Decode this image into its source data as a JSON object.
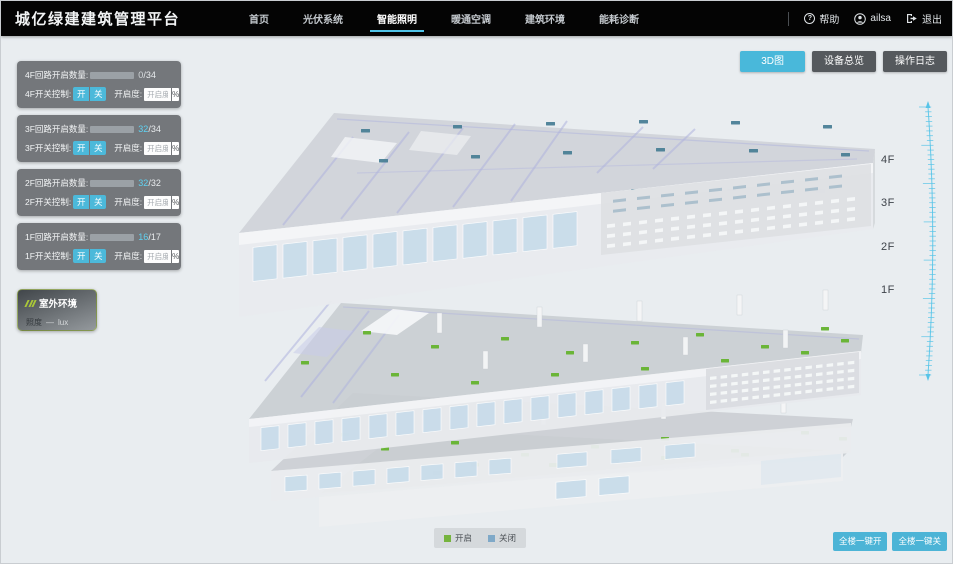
{
  "app": {
    "title": "城亿绿建建筑管理平台"
  },
  "nav": {
    "items": [
      {
        "label": "首页",
        "active": false
      },
      {
        "label": "光伏系统",
        "active": false
      },
      {
        "label": "智能照明",
        "active": true
      },
      {
        "label": "暖通空调",
        "active": false
      },
      {
        "label": "建筑环境",
        "active": false
      },
      {
        "label": "能耗诊断",
        "active": false
      }
    ]
  },
  "user_menu": {
    "help": "帮助",
    "username": "ailsa",
    "logout": "退出"
  },
  "view_toolbar": {
    "buttons": [
      {
        "label": "3D图",
        "active": true
      },
      {
        "label": "设备总览",
        "active": false
      },
      {
        "label": "操作日志",
        "active": false
      }
    ]
  },
  "floor_panels": [
    {
      "floor": "4F",
      "count_label": "4F回路开启数量:",
      "open": "0",
      "total_text": "/34",
      "open_style": "color:#d4d9dc",
      "bar_style": "width:0%",
      "switch_label": "4F开关控制:",
      "on_label": "开",
      "off_label": "关",
      "dim_label": "开启度:",
      "dim_placeholder": "开启度",
      "percent_label": "%"
    },
    {
      "floor": "3F",
      "count_label": "3F回路开启数量:",
      "open": "32",
      "total_text": "/34",
      "open_style": "color:#5fd2f2",
      "bar_style": "width:94%",
      "switch_label": "3F开关控制:",
      "on_label": "开",
      "off_label": "关",
      "dim_label": "开启度:",
      "dim_placeholder": "开启度",
      "percent_label": "%"
    },
    {
      "floor": "2F",
      "count_label": "2F回路开启数量:",
      "open": "32",
      "total_text": "/32",
      "open_style": "color:#5fd2f2",
      "bar_style": "width:100%",
      "switch_label": "2F开关控制:",
      "on_label": "开",
      "off_label": "关",
      "dim_label": "开启度:",
      "dim_placeholder": "开启度",
      "percent_label": "%"
    },
    {
      "floor": "1F",
      "count_label": "1F回路开启数量:",
      "open": "16",
      "total_text": "/17",
      "open_style": "color:#5fd2f2",
      "bar_style": "width:94%",
      "switch_label": "1F开关控制:",
      "on_label": "开",
      "off_label": "关",
      "dim_label": "开启度:",
      "dim_placeholder": "开启度",
      "percent_label": "%"
    }
  ],
  "outdoor_panel": {
    "title": "室外环境",
    "metric_label": "照度",
    "metric_value": "—",
    "metric_unit": "lux"
  },
  "floor_axis_labels": [
    {
      "label": "4F",
      "top": "153px"
    },
    {
      "label": "3F",
      "top": "196px"
    },
    {
      "label": "2F",
      "top": "240px"
    },
    {
      "label": "1F",
      "top": "283px"
    }
  ],
  "legend": {
    "items": [
      {
        "label": "开启",
        "sq_style": "background:#76b43e"
      },
      {
        "label": "关闭",
        "sq_style": "background:#7fa9c8"
      }
    ]
  },
  "bulk_controls": {
    "buttons": [
      {
        "label": "全楼一键开"
      },
      {
        "label": "全楼一键关"
      }
    ]
  },
  "colors": {
    "accent_cyan": "#49b8da",
    "nav_bg": "#040404",
    "page_bg": "#e9edf0",
    "panel_bg": "#6a6e72",
    "bar_track": "#9ba1a6",
    "bar_fill": "#54c8e9",
    "open_green": "#64b32e",
    "closed_blue": "#7fa9c8",
    "lamp_closed_teal": "#4a8096",
    "lime_icon": "#aac838",
    "ruler_cyan": "#57c4e8",
    "dark_button": "#55595d"
  }
}
